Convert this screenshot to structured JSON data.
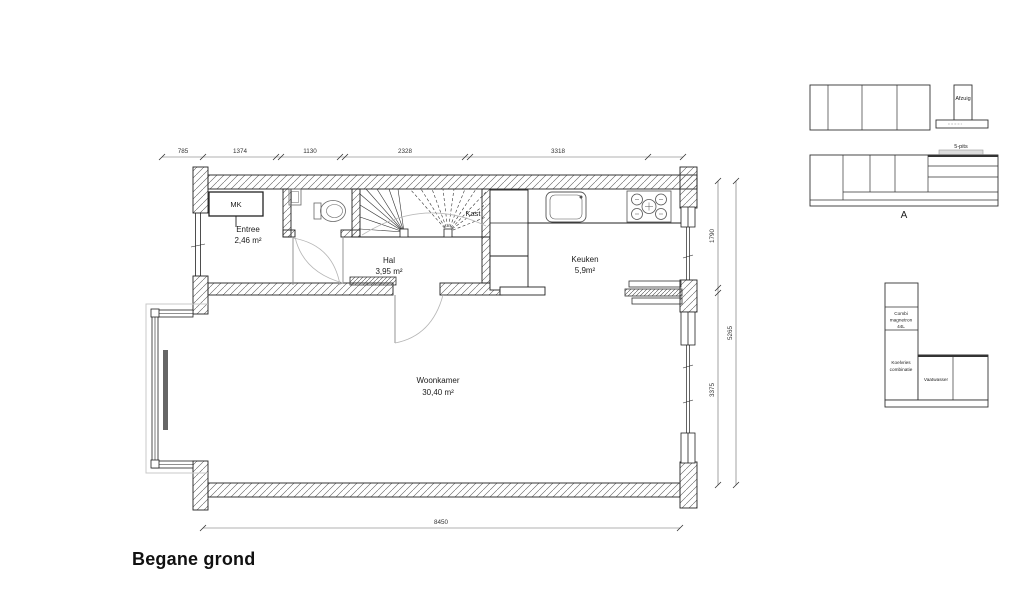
{
  "page": {
    "title": "Begane grond"
  },
  "plan": {
    "rooms": {
      "mk": "MK",
      "entree": {
        "name": "Entree",
        "area": "2,46 m²"
      },
      "hal": {
        "name": "Hal",
        "area": "3,95 m²"
      },
      "kast": "Kast",
      "keuken": {
        "name": "Keuken",
        "area": "5,9m²"
      },
      "woonkamer": {
        "name": "Woonkamer",
        "area": "30,40 m²"
      }
    },
    "dimensions": {
      "top": [
        "785",
        "1374",
        "1130",
        "2328",
        "3318"
      ],
      "right_segments": [
        "1790",
        "3375"
      ],
      "right_total": "5265",
      "bottom": "8450"
    }
  },
  "kitchen_elevation": {
    "section_label": "A",
    "hood": "Afzuig",
    "cooktop": "5-pits",
    "appliances": [
      [
        "Combi",
        "magnetron",
        "44L"
      ],
      [
        "Koelvries",
        "combinatie"
      ],
      [
        "Vaatwasser"
      ]
    ]
  }
}
